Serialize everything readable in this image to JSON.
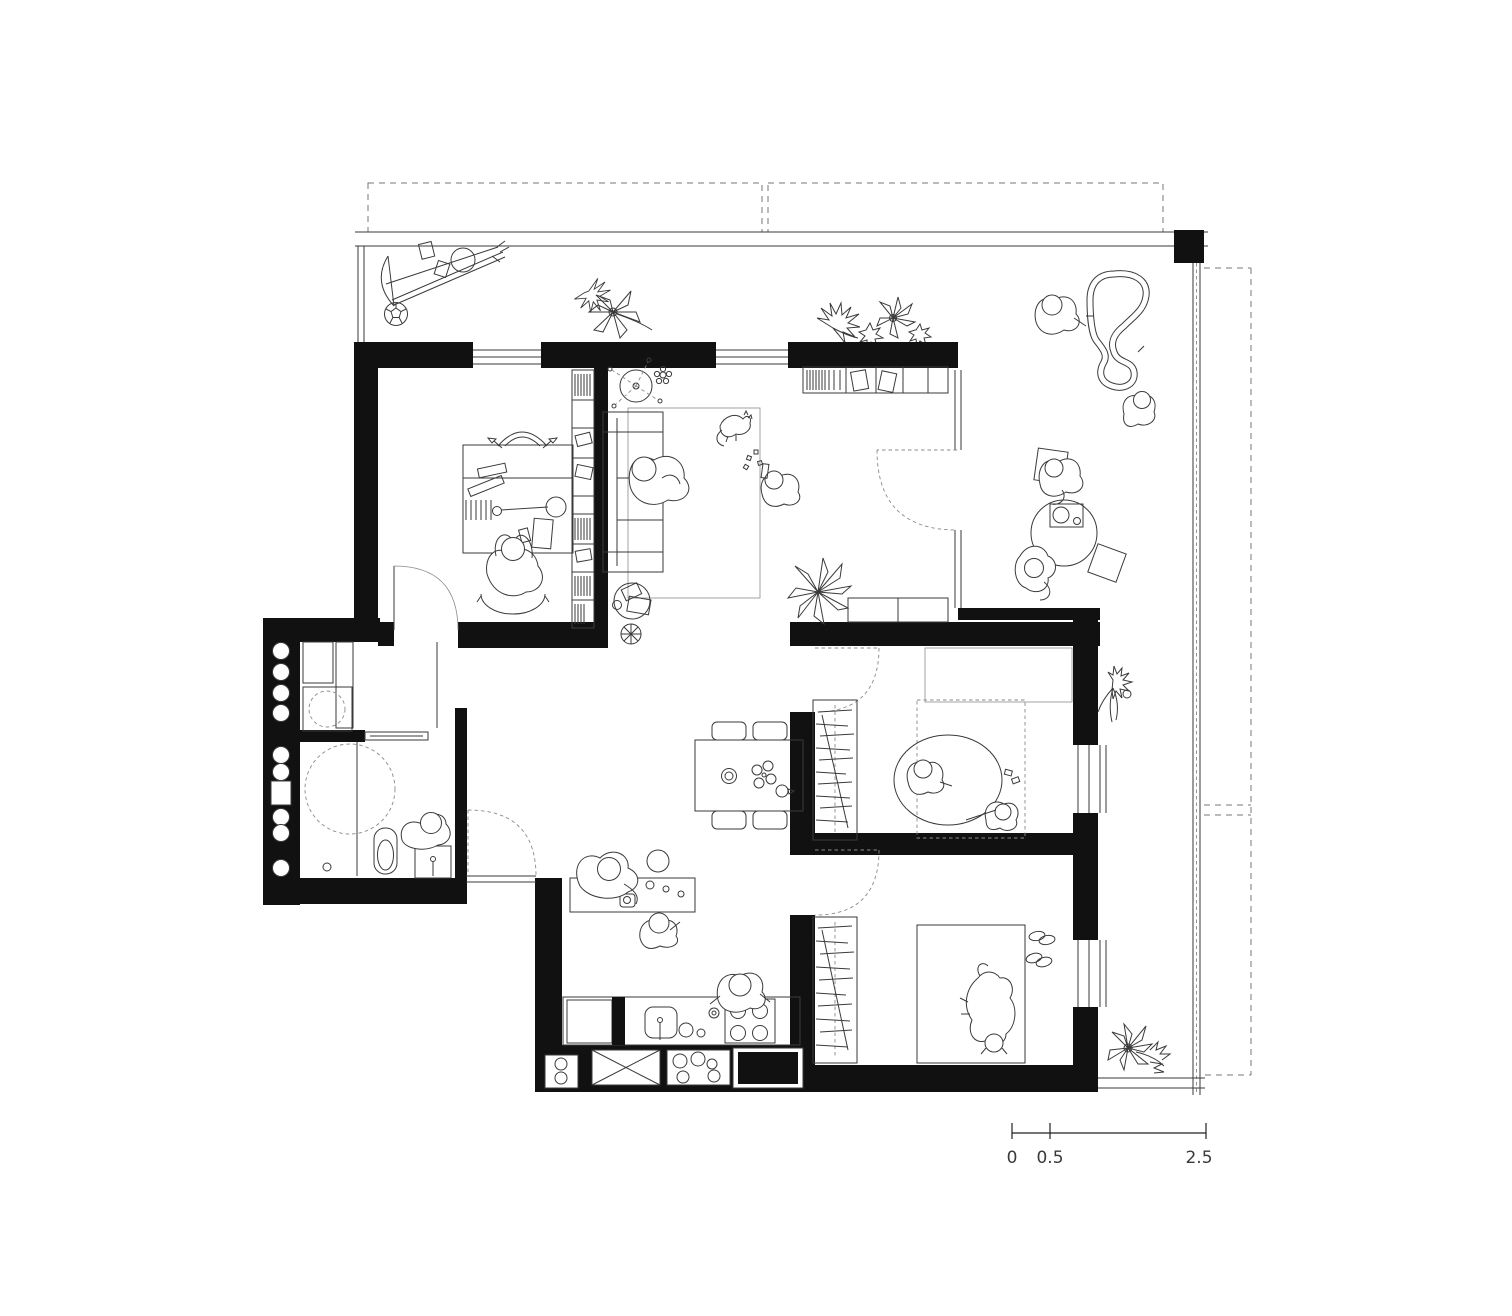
{
  "page": {
    "background": "#ffffff"
  },
  "drawing": {
    "type": "architectural-floor-plan",
    "ink_color": "#3a3a3a",
    "wall_color": "#111111",
    "dashed_color": "#777777",
    "scale_bar": {
      "labels": [
        "0",
        "0.5",
        "2.5"
      ],
      "text_color": "#3a3a3a"
    },
    "rooms": [
      "balcony-top",
      "terrace-right",
      "office",
      "living-room",
      "laundry",
      "bathroom",
      "hall-dining",
      "kitchen",
      "bedroom-1",
      "bedroom-2"
    ],
    "elements": [
      "toy-bow-and-arrows",
      "soccer-ball",
      "plant",
      "desk",
      "desk-chair",
      "office-person",
      "bookshelf",
      "sofa",
      "sofa-person",
      "rug",
      "cat",
      "playing-child",
      "toy-mobile",
      "coffee-table",
      "floor-lamp",
      "tv-shelf",
      "sideboard",
      "agave-plant",
      "toy-race-track",
      "standing-person",
      "sitting-child",
      "round-low-table",
      "tray",
      "chair-person",
      "floor-person",
      "cushion",
      "column",
      "railing",
      "storage-shaft-wall",
      "cabinet",
      "washing-machine",
      "sliding-door",
      "shower-circle",
      "toilet",
      "wash-basin",
      "basin-person",
      "entrance-door",
      "dining-table",
      "dining-chair",
      "plate",
      "kitchen-island",
      "stool",
      "island-adult",
      "island-child",
      "cook-person",
      "counter",
      "sink",
      "hob",
      "appliance-box",
      "wardrobe",
      "bed",
      "round-rug",
      "child",
      "dog",
      "slippers",
      "door-swing",
      "window",
      "flower"
    ]
  }
}
